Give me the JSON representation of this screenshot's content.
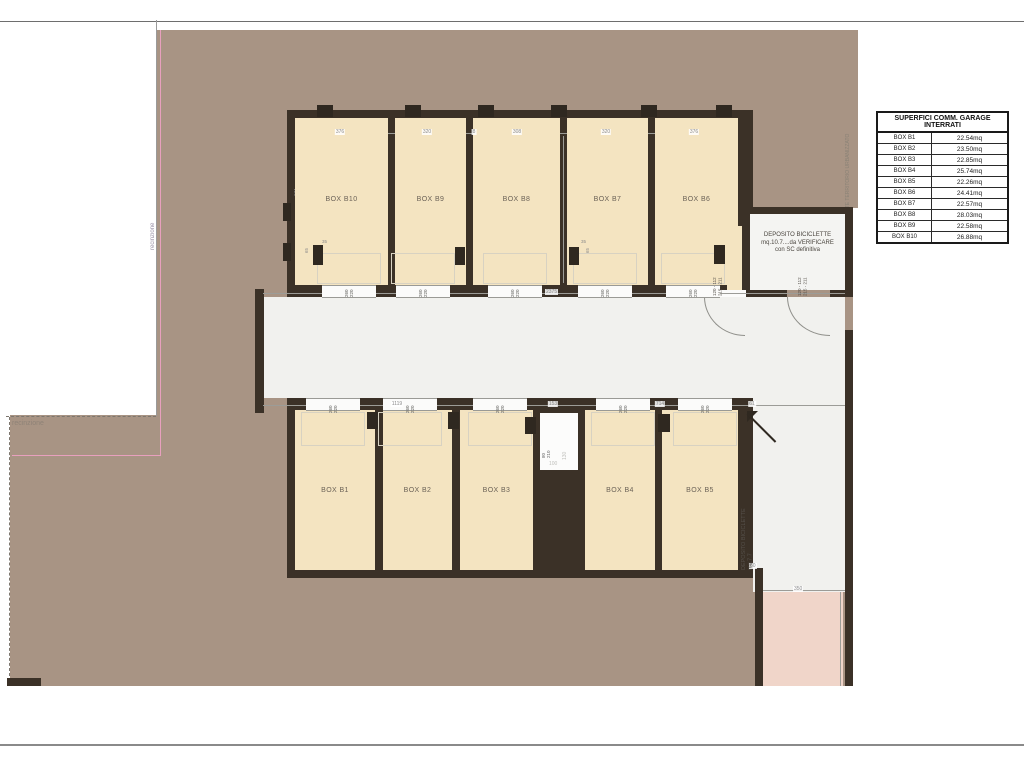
{
  "legend_table": {
    "title": "SUPERFICI COMM. GARAGE INTERRATI",
    "rows": [
      {
        "box": "BOX B1",
        "area": "22.54mq"
      },
      {
        "box": "BOX B2",
        "area": "23.50mq"
      },
      {
        "box": "BOX B3",
        "area": "22.85mq"
      },
      {
        "box": "BOX B4",
        "area": "25.74mq"
      },
      {
        "box": "BOX B5",
        "area": "22.26mq"
      },
      {
        "box": "BOX B6",
        "area": "24.41mq"
      },
      {
        "box": "BOX B7",
        "area": "22.57mq"
      },
      {
        "box": "BOX B8",
        "area": "28.03mq"
      },
      {
        "box": "BOX B9",
        "area": "22.58mq"
      },
      {
        "box": "BOX B10",
        "area": "26.88mq"
      }
    ]
  },
  "plan": {
    "top_row_boxes": [
      "BOX B10",
      "BOX B9",
      "BOX B8",
      "BOX B7",
      "BOX B6"
    ],
    "bottom_row_boxes": [
      "BOX B1",
      "BOX B2",
      "BOX B3",
      "BOX B4",
      "BOX B5"
    ],
    "deposito_top": {
      "line1": "DEPOSITO BICICLETTE",
      "line2": "mq.10.7....da VERIFICARE",
      "line3": "con SC definitiva"
    },
    "deposito_right": {
      "line1": "DEPOSITO BICICLETTE",
      "line2": "mq.7.7"
    },
    "garage_door_size": {
      "w": "260",
      "h": "220"
    },
    "pedestrian_door_size": {
      "line1": "120 - 112",
      "line2": "215 - 211"
    },
    "top_width_dims": [
      "376",
      "320",
      "8",
      "308",
      "320",
      "376"
    ],
    "depth_dims": {
      "left": "671",
      "mid": "671",
      "right": "404"
    },
    "corridor_dim_top": "2375",
    "corridor_dims_bottom": [
      "1119",
      "153",
      "714",
      "61"
    ],
    "misc_dims": {
      "ramp": "350",
      "b5_depth": "500",
      "b5_width": "250",
      "step": "60",
      "pillar_w": "35",
      "pillar_h": "65"
    },
    "shaft_dims": {
      "door_w": "80",
      "door_h": "210",
      "d1": "130",
      "d2": "100"
    },
    "boundary_labels": {
      "territory": "LIMITE TERRITORIO URBANIZZATO",
      "fence_left": "recinzione",
      "fence_bottom": "recinzione"
    }
  },
  "colors": {
    "land": "#a89484",
    "box_fill": "#f4e4c1",
    "wall": "#3b3127",
    "floor": "#f1f1ee",
    "ramp": "#f0d5c9",
    "fence_line": "#e8a0be"
  }
}
